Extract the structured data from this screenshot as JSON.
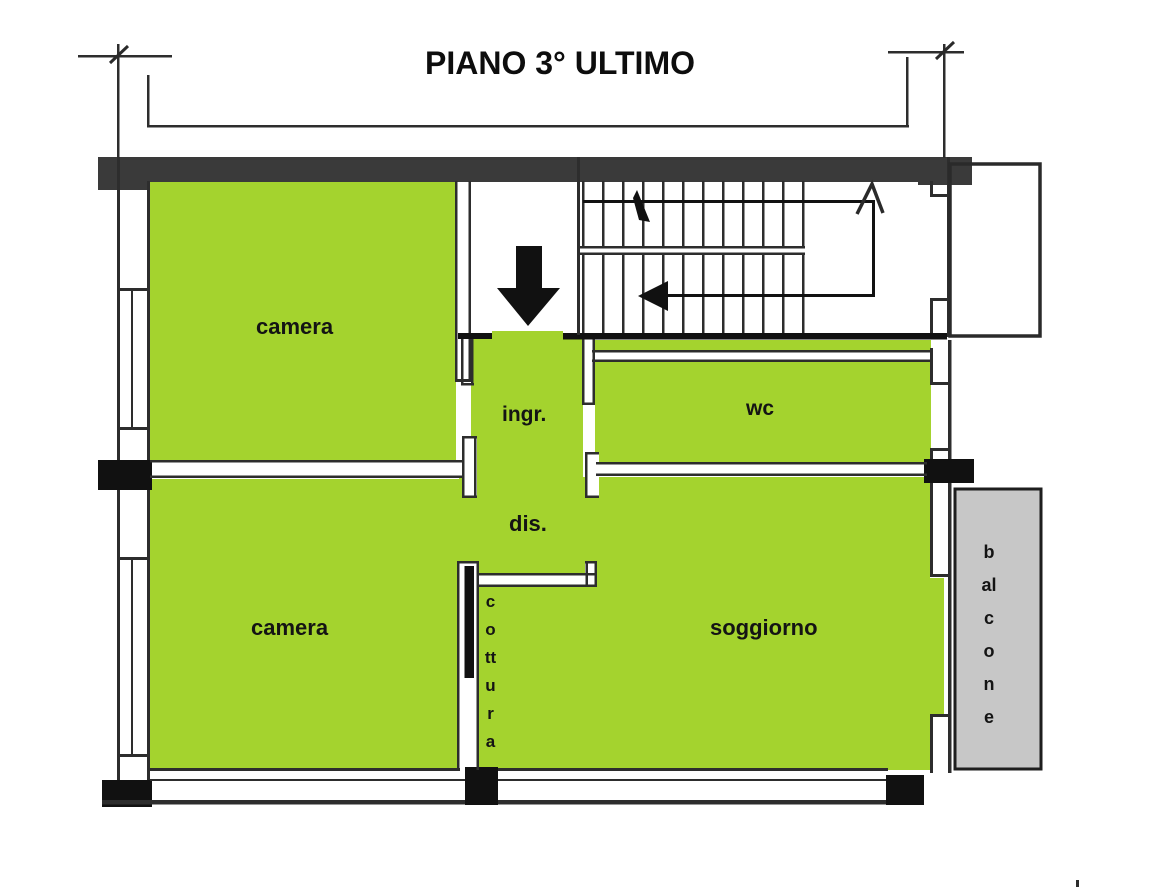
{
  "title": "PIANO 3° ULTIMO",
  "rooms": {
    "camera_top": {
      "label": "camera"
    },
    "ingresso": {
      "label": "ingr."
    },
    "wc": {
      "label": "wc"
    },
    "disimpegno": {
      "label": "dis."
    },
    "camera_bottom": {
      "label": "camera"
    },
    "soggiorno": {
      "label": "soggiorno"
    },
    "cottura": {
      "label": "cottura"
    },
    "balcone": {
      "label": "balcone"
    }
  },
  "colors": {
    "room_fill": "#a4d32e",
    "balcony_fill": "#c7c7c7",
    "wall_dark": "#2d2d2d",
    "wall_heavy": "#3a3a3a",
    "ink": "#111111"
  }
}
